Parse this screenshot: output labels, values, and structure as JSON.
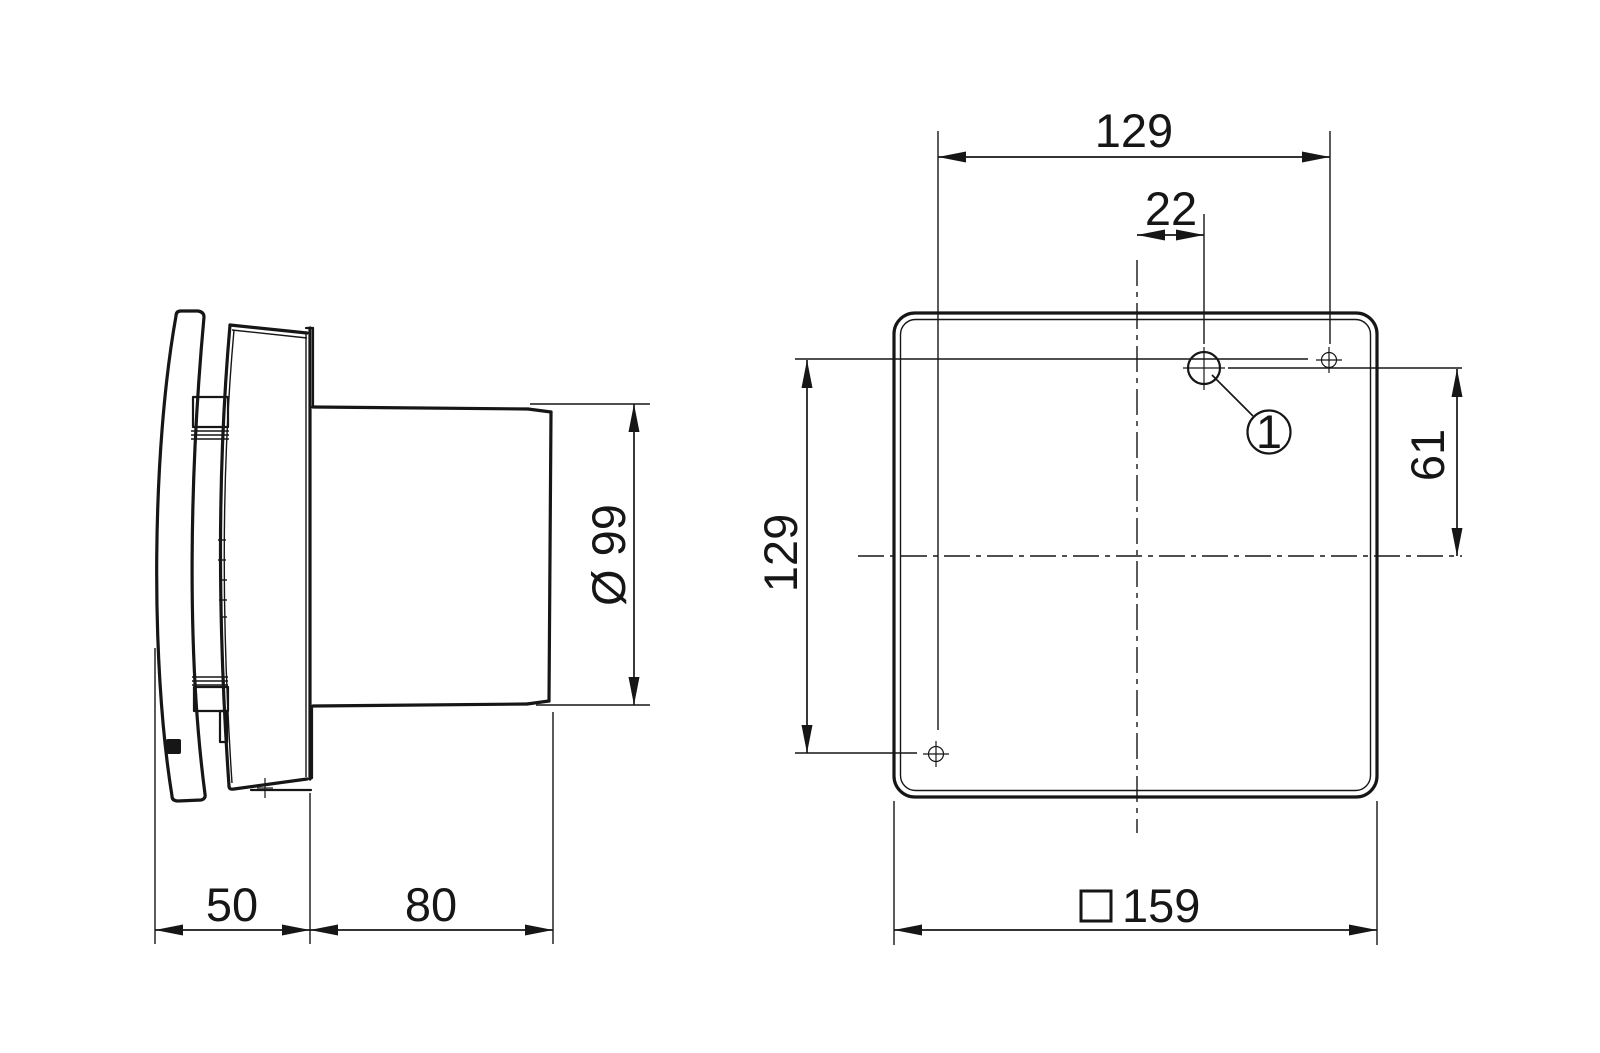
{
  "drawing": {
    "description": "Technical dimensional drawing of a wall-mounted fan: side view and front (mounting plate) view",
    "units": "mm",
    "colors": {
      "line": "#161616",
      "background": "#ffffff"
    },
    "side_view": {
      "depth_cover": "50",
      "depth_duct": "80",
      "duct_diameter": "Ø 99"
    },
    "front_view": {
      "hole_spacing_horizontal": "129",
      "cable_entry_offset": "22",
      "hole_spacing_vertical": "129",
      "cable_entry_height": "61",
      "plate_size": "159",
      "callout": "1"
    }
  }
}
